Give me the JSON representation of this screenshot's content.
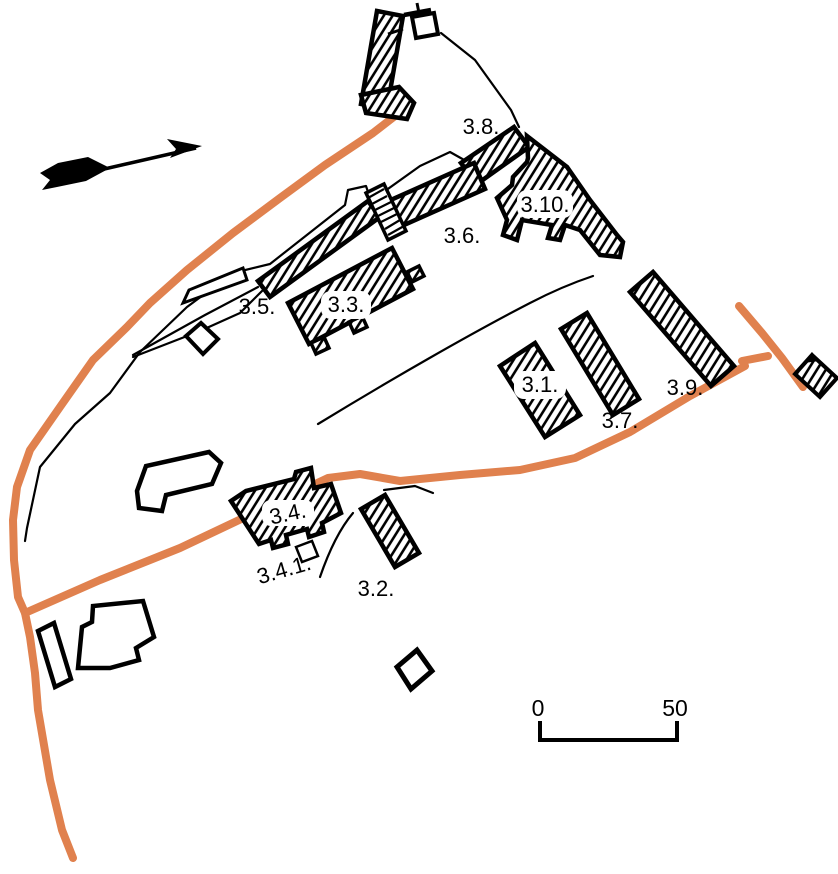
{
  "figure": {
    "kind": "archaeological site plan",
    "background": "#ffffff"
  },
  "colors": {
    "road": "#e0814e",
    "outline": "#000000",
    "building_fill": "#ffffff"
  },
  "north_arrow": {
    "present": "true",
    "points": "east-northeast"
  },
  "labels": {
    "b1": "3.1.",
    "b2": "3.2.",
    "b3": "3.3.",
    "b4": "3.4.",
    "b41": "3.4.1.",
    "b5": "3.5.",
    "b6": "3.6.",
    "b7": "3.7.",
    "b8": "3.8.",
    "b9": "3.9.",
    "b10": "3.10."
  },
  "scale_bar": {
    "start": "0",
    "end": "50"
  }
}
